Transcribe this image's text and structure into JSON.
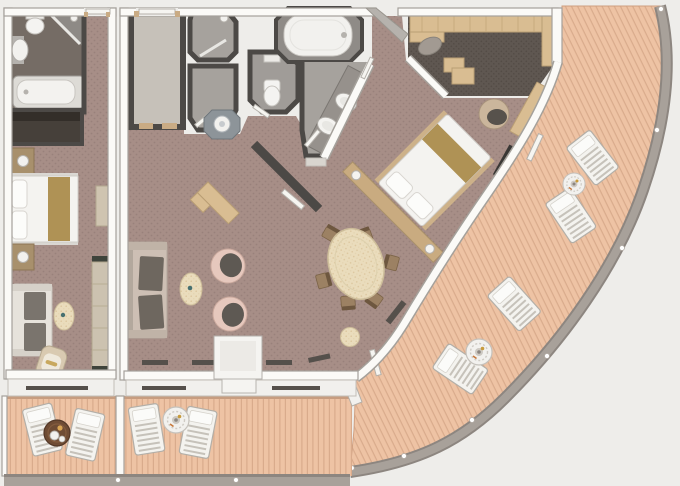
{
  "title": "Two-bedroom suite floor plan with curved wrap-around veranda (top-down 3D render)",
  "palette": {
    "bg": "#eeedea",
    "wall": "#fbfaf7",
    "wallEdge": "#a5a19b",
    "wallDark": "#4c4946",
    "carpet": "#a78e87",
    "carpetDot": "#99817b",
    "carpetDark": "#5f5751",
    "carpetDarkDot": "#534b45",
    "floorGray": "#a6a29d",
    "floorFoyer": "#c6c1b9",
    "floorBathDark": "#756c65",
    "deck": "#eec3a4",
    "plank": "#d9ab8c",
    "rail": "#a8a19a",
    "railEdge": "#8d8680",
    "woodLight": "#d9bd92",
    "woodEdge": "#b99e74",
    "woodMid": "#c9ab80",
    "linen": "#f4f3f0",
    "gold": "#af9255",
    "sofa": "#cdbfb4",
    "cushion": "#6e675f",
    "pink": "#e6c8bd",
    "pinkEdge": "#caa99d",
    "seatDark": "#5e5953",
    "cream": "#eadcbc",
    "creamEdge": "#cdbd9a",
    "teal": "#477070",
    "tableDark": "#6f4c34",
    "orange": "#c8793c",
    "white": "#f2f1ee"
  },
  "areas": {
    "guest_bathroom": {
      "label": "Guest bathroom with tub, corner shower, toilet and basin"
    },
    "guest_closet": {
      "label": "Guest wardrobe closet"
    },
    "guest_bedroom": {
      "label": "Guest bedroom with double bed and nightstand cabinets"
    },
    "guest_living": {
      "label": "Guest sitting area with sofa, oval table, armchair and console"
    },
    "guest_balcony": {
      "label": "Guest balcony with two sun loungers and round table"
    },
    "foyer": {
      "label": "Entrance foyer"
    },
    "shower_room": {
      "label": "Guest shower room"
    },
    "powder_room": {
      "label": "Washroom with octagonal basin stand"
    },
    "master_wc": {
      "label": "Master water closet"
    },
    "master_bath": {
      "label": "Master bathroom with double vanity"
    },
    "master_tub": {
      "label": "Large whirlpool bathtub"
    },
    "walk_in_closet": {
      "label": "Walk-in closet with shelving, ottoman and dresser"
    },
    "master_bedroom": {
      "label": "Master bedroom with diagonal king bed and desk"
    },
    "dining_area": {
      "label": "Dining area with oval table and six chairs"
    },
    "living_room": {
      "label": "Living room with sofa, tub chairs and coffee table"
    },
    "living_balcony": {
      "label": "Living room balcony with two loungers and round table"
    },
    "veranda": {
      "label": "Curved wrap-around veranda with four sun loungers and tables"
    }
  },
  "furnishings": {
    "master_bed": {
      "label": "King bed with gold runner and headboard lamps"
    },
    "guest_bed": {
      "label": "Double bed with gold runner"
    },
    "dining_table": {
      "label": "Oval dining table"
    },
    "sofa": {
      "label": "Living room sofa"
    },
    "tub_chairs": {
      "label": "Pair of pink tub chairs"
    },
    "desk": {
      "label": "Writing desk with chair"
    },
    "lounger": {
      "label": "Slatted sun lounger"
    },
    "sun_table": {
      "label": "Round veranda table"
    },
    "cafe_table": {
      "label": "Dark round balcony table with tea set"
    }
  }
}
